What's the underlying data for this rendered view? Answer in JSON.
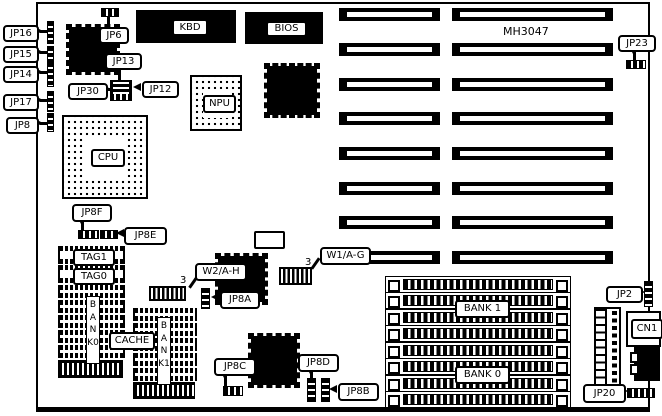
{
  "diagram": {
    "board_model": "MH3047",
    "colors": {
      "ink": "#000000",
      "background": "#ffffff"
    },
    "chip_labels": {
      "kbd": "KBD",
      "bios": "BIOS",
      "npu": "NPU",
      "cpu": "CPU",
      "tag1": "TAG1",
      "tag0": "TAG0",
      "cache": "CACHE",
      "bank0_vertical": "BANK0",
      "bank1_vertical": "BANK1",
      "simm_bank1": "BANK 1",
      "simm_bank0": "BANK 0",
      "cn1": "CN1"
    },
    "jumper_labels": {
      "jp16": "JP16",
      "jp15": "JP15",
      "jp14": "JP14",
      "jp17": "JP17",
      "jp8": "JP8",
      "jp6": "JP6",
      "jp13": "JP13",
      "jp30": "JP30",
      "jp12": "JP12",
      "jp23": "JP23",
      "jp8f": "JP8F",
      "jp8e": "JP8E",
      "w2ah": "W2/A-H",
      "w1ag": "W1/A-G",
      "jp8a": "JP8A",
      "jp8c": "JP8C",
      "jp8d": "JP8D",
      "jp8b": "JP8B",
      "jp2": "JP2",
      "jp20": "JP20"
    },
    "pin_annotations": {
      "w2_pin3": "3",
      "w1_pin3": "3"
    }
  }
}
